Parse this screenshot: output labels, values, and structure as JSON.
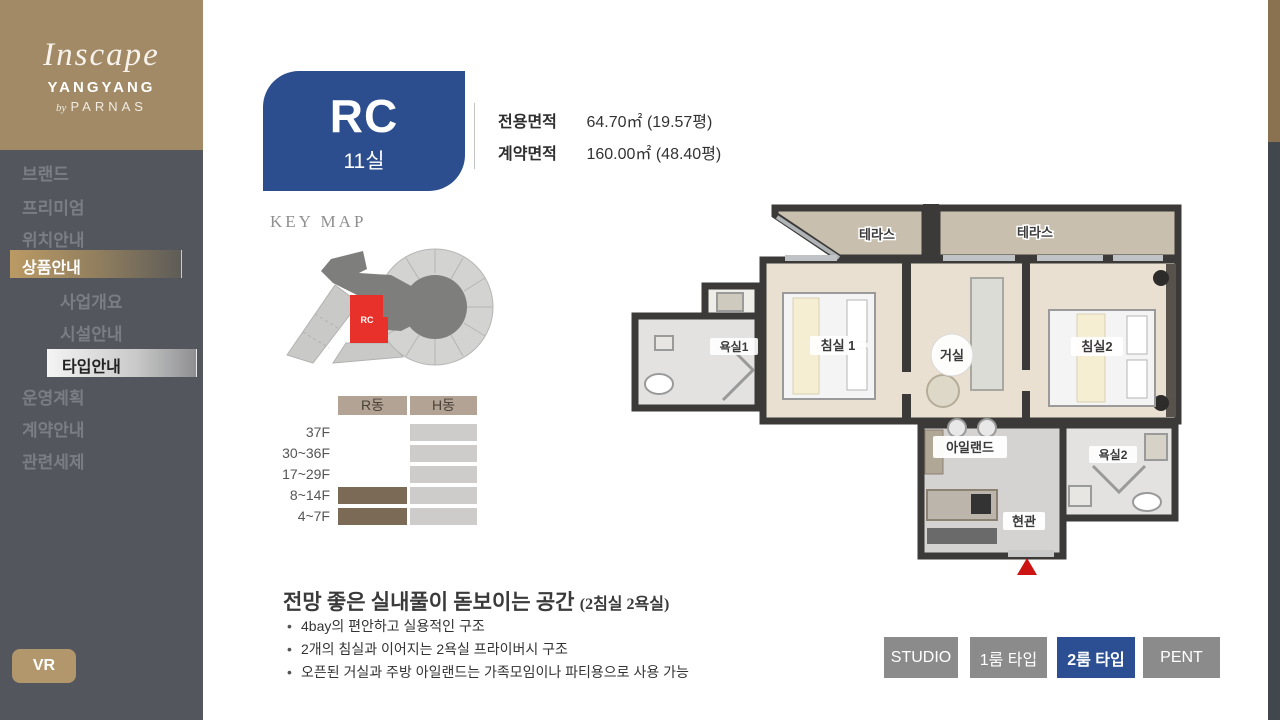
{
  "brand": {
    "logo_script": "Inscape",
    "logo_sub": "YANGYANG",
    "logo_by": "by",
    "logo_parnas": "PARNAS"
  },
  "sidebar": {
    "items": [
      {
        "label": "브랜드",
        "active": false,
        "sub": false
      },
      {
        "label": "프리미엄",
        "active": false,
        "sub": false
      },
      {
        "label": "위치안내",
        "active": false,
        "sub": false
      },
      {
        "label": "상품안내",
        "active": true,
        "sub": false
      },
      {
        "label": "사업개요",
        "active": false,
        "sub": true
      },
      {
        "label": "시설안내",
        "active": false,
        "sub": true
      },
      {
        "label": "타입안내",
        "active": true,
        "sub": true
      },
      {
        "label": "운영계획",
        "active": false,
        "sub": false
      },
      {
        "label": "계약안내",
        "active": false,
        "sub": false
      },
      {
        "label": "관련세제",
        "active": false,
        "sub": false
      }
    ],
    "vr_label": "VR"
  },
  "unit": {
    "type_code": "RC",
    "unit_count": "11실"
  },
  "area_info": {
    "rows": [
      {
        "label": "전용면적",
        "value": "64.70㎡ (19.57평)"
      },
      {
        "label": "계약면적",
        "value": "160.00㎡ (48.40평)"
      }
    ]
  },
  "key_map": {
    "title": "KEY MAP",
    "highlight_label": "RC",
    "highlight_color": "#e8312a"
  },
  "floor_table": {
    "columns": [
      "R동",
      "H동"
    ],
    "rows": [
      {
        "floor": "37F",
        "r_filled": false,
        "h_filled": true
      },
      {
        "floor": "30~36F",
        "r_filled": false,
        "h_filled": true
      },
      {
        "floor": "17~29F",
        "r_filled": false,
        "h_filled": true
      },
      {
        "floor": "8~14F",
        "r_filled": true,
        "h_filled": true
      },
      {
        "floor": "4~7F",
        "r_filled": true,
        "h_filled": true
      }
    ],
    "r_fill_color": "#7b6b56",
    "h_fill_color": "#cdccca"
  },
  "floor_plan": {
    "labels": {
      "terrace1": "테라스",
      "terrace2": "테라스",
      "bedroom1": "침실 1",
      "living": "거실",
      "bedroom2": "침실2",
      "bath1": "욕실1",
      "island": "아일랜드",
      "bath2": "욕실2",
      "entrance": "현관"
    }
  },
  "description": {
    "heading": "전망 좋은 실내풀이 돋보이는 공간 ",
    "heading_suffix": "(2침실 2욕실)",
    "bullets": [
      "4bay의 편안하고 실용적인 구조",
      "2개의 침실과 이어지는 2욕실 프라이버시 구조",
      "오픈된 거실과 주방 아일랜드는 가족모임이나 파티용으로 사용 가능"
    ]
  },
  "type_tabs": {
    "items": [
      {
        "label": "STUDIO",
        "active": false
      },
      {
        "label": "1룸 타입",
        "active": false
      },
      {
        "label": "2룸 타입",
        "active": true
      },
      {
        "label": "PENT",
        "active": false
      }
    ]
  },
  "colors": {
    "accent_gold": "#a28a66",
    "accent_blue": "#2c4e8e",
    "sidebar_bg": "#54565d",
    "tab_gray": "#8b8b8b",
    "entrance_marker_red": "#cc1414"
  }
}
